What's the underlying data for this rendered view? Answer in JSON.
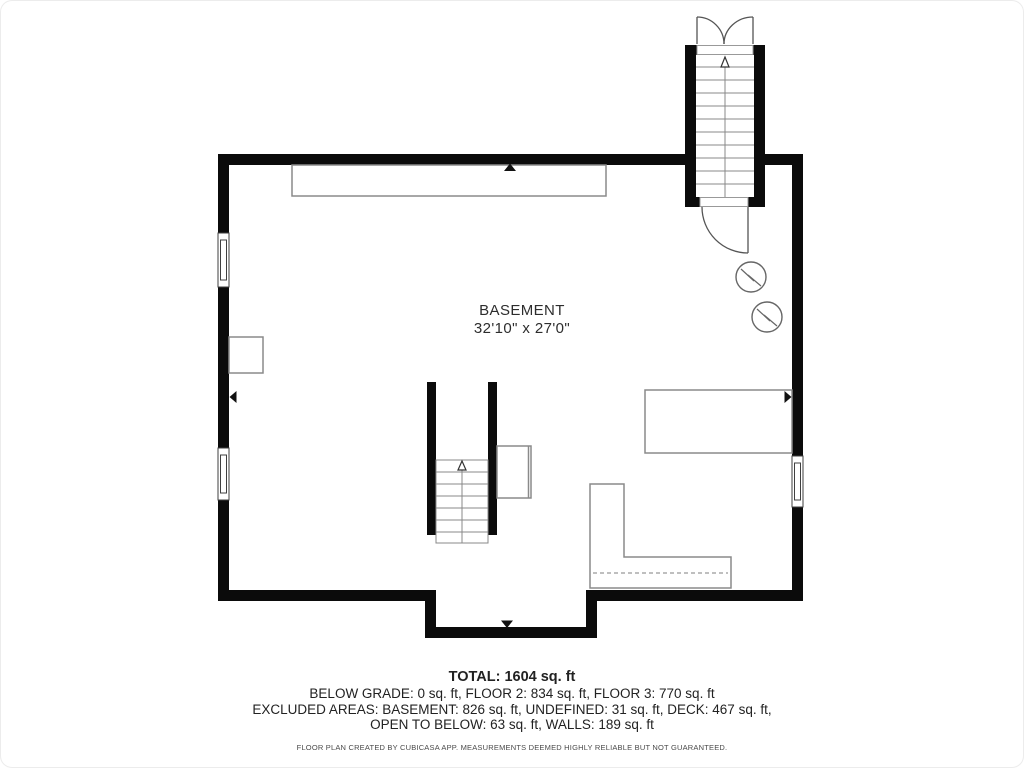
{
  "floorplan": {
    "room_label": "BASEMENT",
    "room_dimensions": "32'10\" x 27'0\"",
    "icons": {
      "water_heater": "circle-zigzag",
      "stair_direction": "up-arrow",
      "dimension_marker": "small-triangle",
      "door": "quarter-circle-swing",
      "double_door": "double-quarter-circle-swing"
    },
    "colors": {
      "wall": "#0b0b0b",
      "thin_outline": "#8a8a8a",
      "stair_line": "#888888",
      "door_line": "#555555",
      "text": "#2d2d2d"
    }
  },
  "summary": {
    "total": "TOTAL: 1604 sq. ft",
    "floors": "BELOW GRADE: 0 sq. ft, FLOOR 2: 834 sq. ft, FLOOR 3: 770 sq. ft",
    "excluded_1": "EXCLUDED AREAS: BASEMENT: 826 sq. ft, UNDEFINED: 31 sq. ft, DECK: 467 sq. ft,",
    "excluded_2": "OPEN TO BELOW: 63 sq. ft, WALLS: 189 sq. ft",
    "disclaimer": "FLOOR PLAN CREATED BY CUBICASA APP. MEASUREMENTS DEEMED HIGHLY RELIABLE BUT NOT GUARANTEED."
  }
}
